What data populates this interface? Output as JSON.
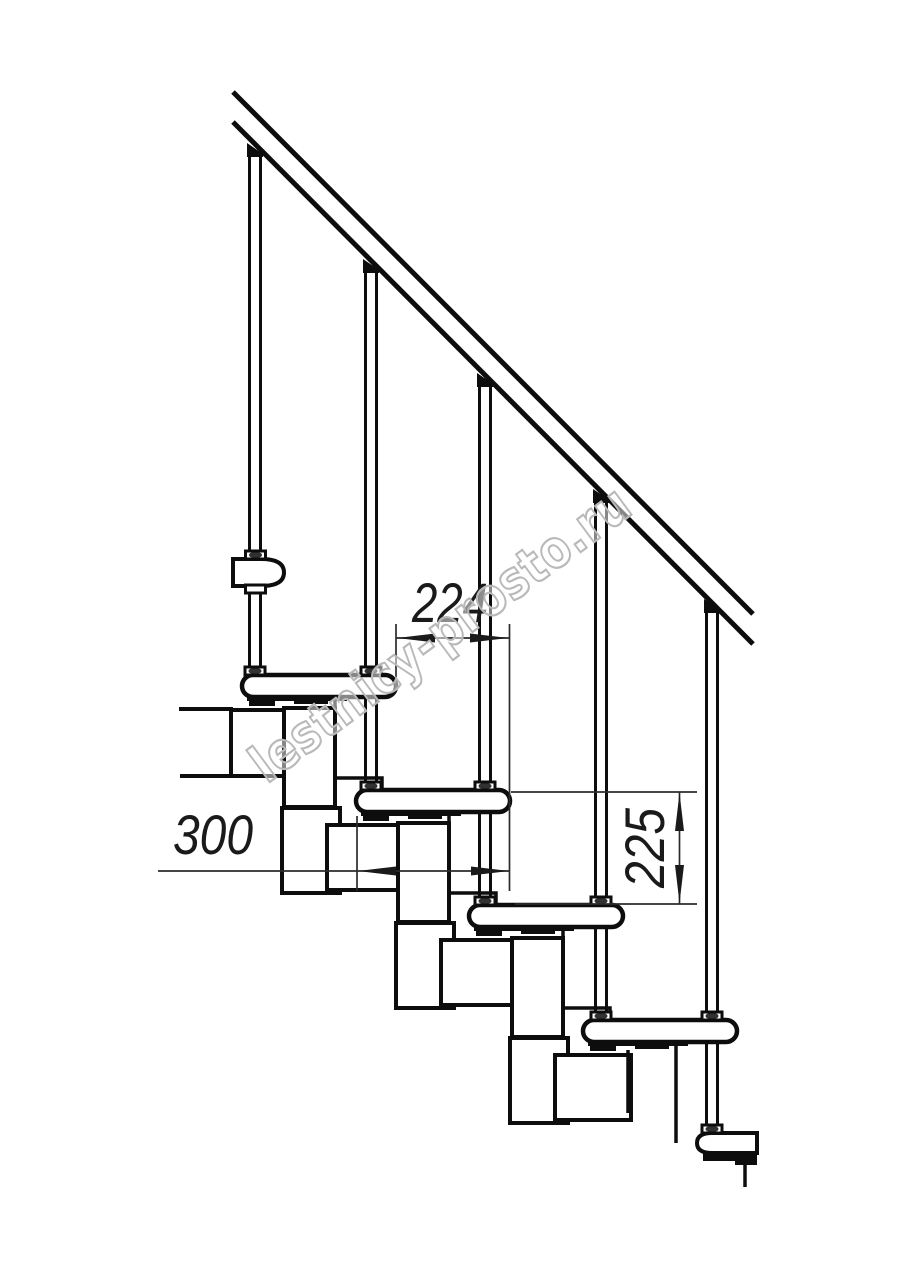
{
  "drawing": {
    "line_color": "#0d0d0d",
    "dimension_color": "#1a1a1a",
    "background_color": "#ffffff",
    "dimensions": [
      {
        "id": "step-run-horizontal",
        "label": "224",
        "orientation": "horizontal"
      },
      {
        "id": "tread-depth-horizontal",
        "label": "300",
        "orientation": "horizontal"
      },
      {
        "id": "step-rise-vertical",
        "label": "225",
        "orientation": "vertical"
      }
    ],
    "watermark": {
      "text": "lestnicy-prosto.ru",
      "color": "#b9b9b9"
    }
  }
}
